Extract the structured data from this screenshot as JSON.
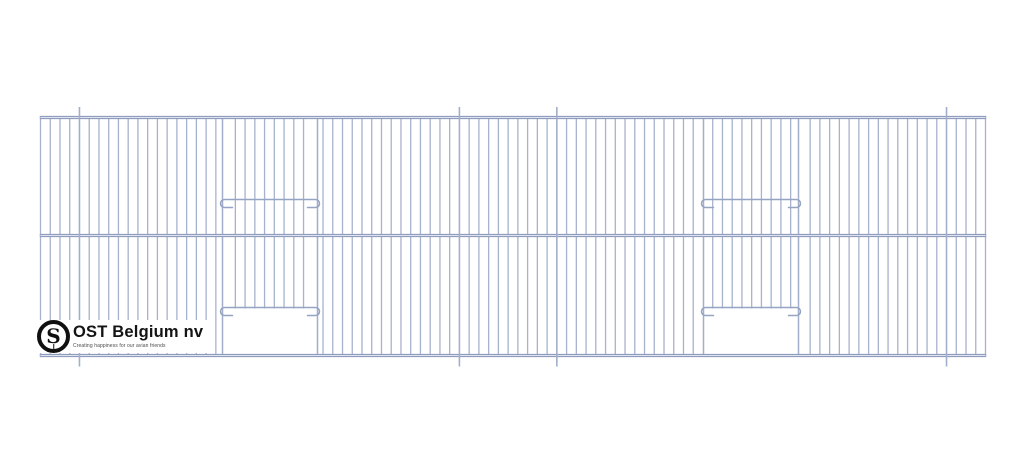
{
  "logo": {
    "company": "OST Belgium nv",
    "tagline": "Creating happiness for our avian friends",
    "monogram": "S"
  },
  "drawing": {
    "title": "cage-front-panel",
    "background": "#ffffff",
    "bar_color": "#a3aeca",
    "bar_width": 1.3,
    "rail_color": "#8f9cbd",
    "rail_width": 3.2,
    "rail_core_color": "#dde3ef",
    "wire_color": "#96a3c2",
    "panel": {
      "left": 40.5,
      "right": 985.5,
      "top": 117.5,
      "mid": 235.5,
      "bottom": 355.5
    },
    "bar_count": 98,
    "long_wires": {
      "indices": [
        4,
        43,
        53,
        93
      ],
      "top": 107,
      "bottom": 366.5,
      "width": 1.6
    },
    "doors": [
      {
        "x1": 222.5,
        "x2": 317.5
      },
      {
        "x1": 703.5,
        "x2": 798.5
      }
    ],
    "upper_wire_y": 199.5,
    "door_wire_y": 307.5,
    "opening_top": 308.5,
    "hook": {
      "radius": 4,
      "arm": 10
    }
  }
}
